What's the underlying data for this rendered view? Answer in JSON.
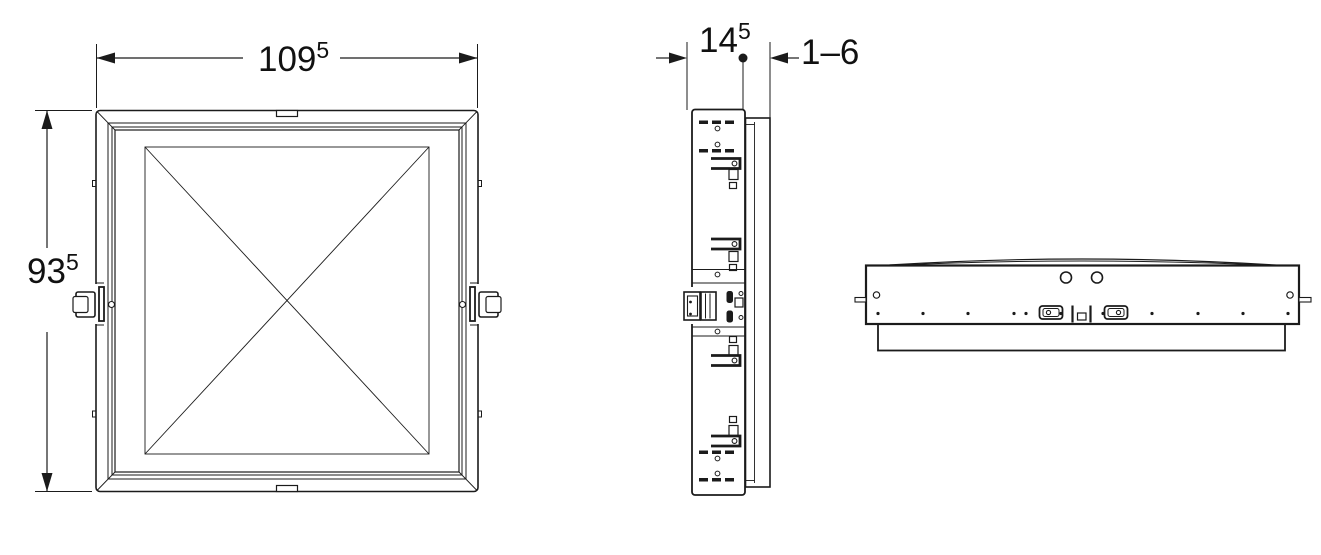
{
  "drawing": {
    "type": "technical-orthographic-views",
    "views": {
      "front": "front-view",
      "side": "side-profile-view",
      "plan": "plan-view"
    },
    "dimensions": {
      "width": {
        "main": "109",
        "sup": "5"
      },
      "height": {
        "main": "93",
        "sup": "5"
      },
      "depth": {
        "main": "14",
        "sup": "5"
      },
      "tile_thickness": {
        "main": "1–6"
      }
    },
    "colors": {
      "line": "#1b1b1b",
      "background": "#ffffff"
    }
  }
}
